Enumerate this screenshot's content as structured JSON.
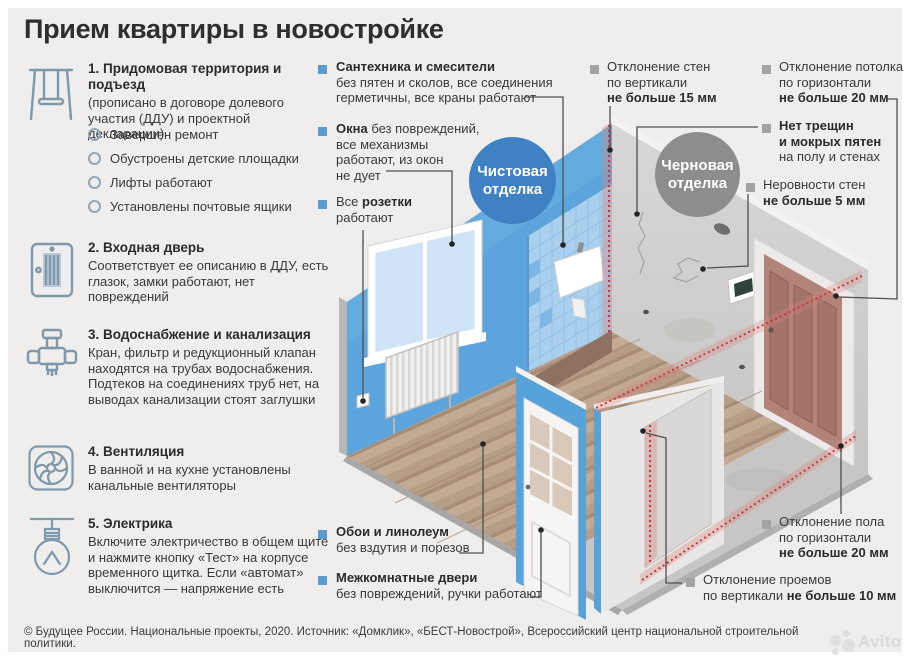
{
  "title": "Прием квартиры в новостройке",
  "legend": {
    "clean_line1": "Чистовая",
    "clean_line2": "отделка",
    "rough_line1": "Черновая",
    "rough_line2": "отделка"
  },
  "checklist": [
    {
      "num": "1.",
      "heading": "Придомовая территория и подъезд",
      "body": "(прописано в договоре долевого участия (ДДУ) и проектной декларации)",
      "bullets": [
        "Завершен ремонт",
        "Обустроены детские площадки",
        "Лифты работают",
        "Установлены почтовые ящики"
      ]
    },
    {
      "num": "2.",
      "heading": "Входная дверь",
      "body": "Соответствует ее описанию в ДДУ, есть глазок, замки работают, нет повреждений"
    },
    {
      "num": "3.",
      "heading": "Водоснабжение и канализация",
      "body": "Кран, фильтр и редукционный клапан находятся на трубах водоснабжения. Подтеков на соединениях труб нет, на выводах канализации стоят заглушки"
    },
    {
      "num": "4.",
      "heading": "Вентиляция",
      "body": "В ванной и на кухне установлены канальные вентиляторы"
    },
    {
      "num": "5.",
      "heading": "Электрика",
      "body": "Включите электричество в общем щите и нажмите кнопку «Тест» на корпусе временного щитка. Если «автомат» выключится — напряжение есть"
    }
  ],
  "callouts": {
    "plumbing": {
      "l1": "Сантехника и смесители",
      "l2": "без пятен и сколов, все соединения",
      "l3": "герметичны, все краны работают"
    },
    "windows": {
      "b1": "Окна",
      "r1": " без повреждений,",
      "l2": "все механизмы",
      "l3": "работают, из окон",
      "l4": "не дует"
    },
    "sockets": {
      "r1": "Все ",
      "b1": "розетки",
      "l2": "работают"
    },
    "wallpaper": {
      "l1": "Обои и линолеум",
      "l2": "без вздутия и порезов"
    },
    "int_doors": {
      "l1": "Межкомнатные двери",
      "l2": "без повреждений, ручки работают"
    },
    "walls_vertical": {
      "l1": "Отклонение стен",
      "l2": "по вертикали",
      "l3": "не больше 15 мм"
    },
    "ceiling": {
      "l1": "Отклонение потолка",
      "l2": "по горизонтали",
      "l3": "не больше 20 мм"
    },
    "no_cracks": {
      "l1": "Нет трещин",
      "l2": "и мокрых пятен",
      "l3": "на полу и стенах"
    },
    "wall_evenness": {
      "l1": "Неровности стен",
      "l2": "не больше 5 мм"
    },
    "floor_level": {
      "l1": "Отклонение пола",
      "l2": "по горизонтали",
      "l3": "не больше 20 мм"
    },
    "openings": {
      "l1": "Отклонение проемов",
      "r2": "по вертикали ",
      "b2": "не больше 10 мм"
    }
  },
  "footer": "© Будущее России. Национальные проекты, 2020. Источник: «Домклик», «БЕСТ-Новострой», Всероссийский центр национальной строительной политики.",
  "watermark": "Avito",
  "colors": {
    "accent_blue": "#3f82c3",
    "rough_gray": "#8d8d8b",
    "wall_blue": "#5ca5dc",
    "alert_red": "#c23a3a",
    "wood": "#b69d88",
    "icon_stroke": "#7e98ac"
  }
}
